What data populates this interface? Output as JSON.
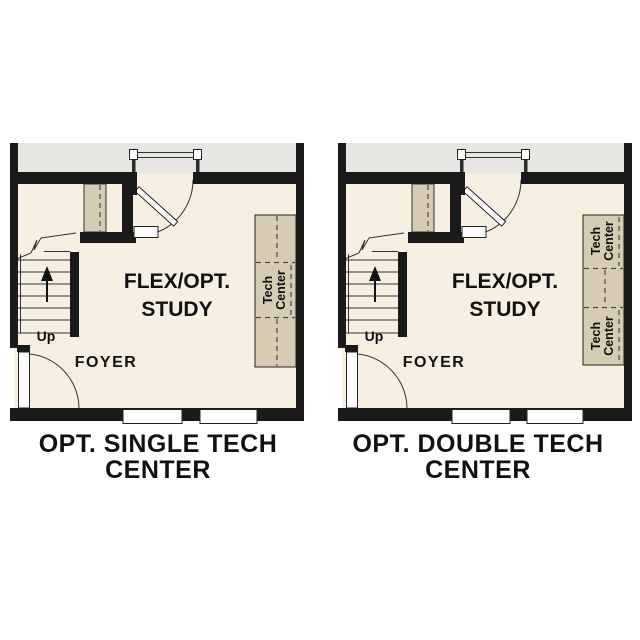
{
  "colors": {
    "background": "#ffffff",
    "wall": "#1a1a1a",
    "room_fill": "#f7f0e2",
    "cabinet_fill": "#d6ccb3",
    "porch_fill": "#e8e6e2",
    "text": "#111111"
  },
  "plans": [
    {
      "caption_line1": "OPT. SINGLE TECH",
      "caption_line2": "CENTER",
      "room_label_line1": "FLEX/OPT.",
      "room_label_line2": "STUDY",
      "foyer_label": "FOYER",
      "stairs_label": "Up",
      "tech_label_line1": "Tech",
      "tech_label_line2": "Center"
    },
    {
      "caption_line1": "OPT. DOUBLE TECH",
      "caption_line2": "CENTER",
      "room_label_line1": "FLEX/OPT.",
      "room_label_line2": "STUDY",
      "foyer_label": "FOYER",
      "stairs_label": "Up",
      "tech_label_line1": "Tech",
      "tech_label_line2": "Center"
    }
  ]
}
